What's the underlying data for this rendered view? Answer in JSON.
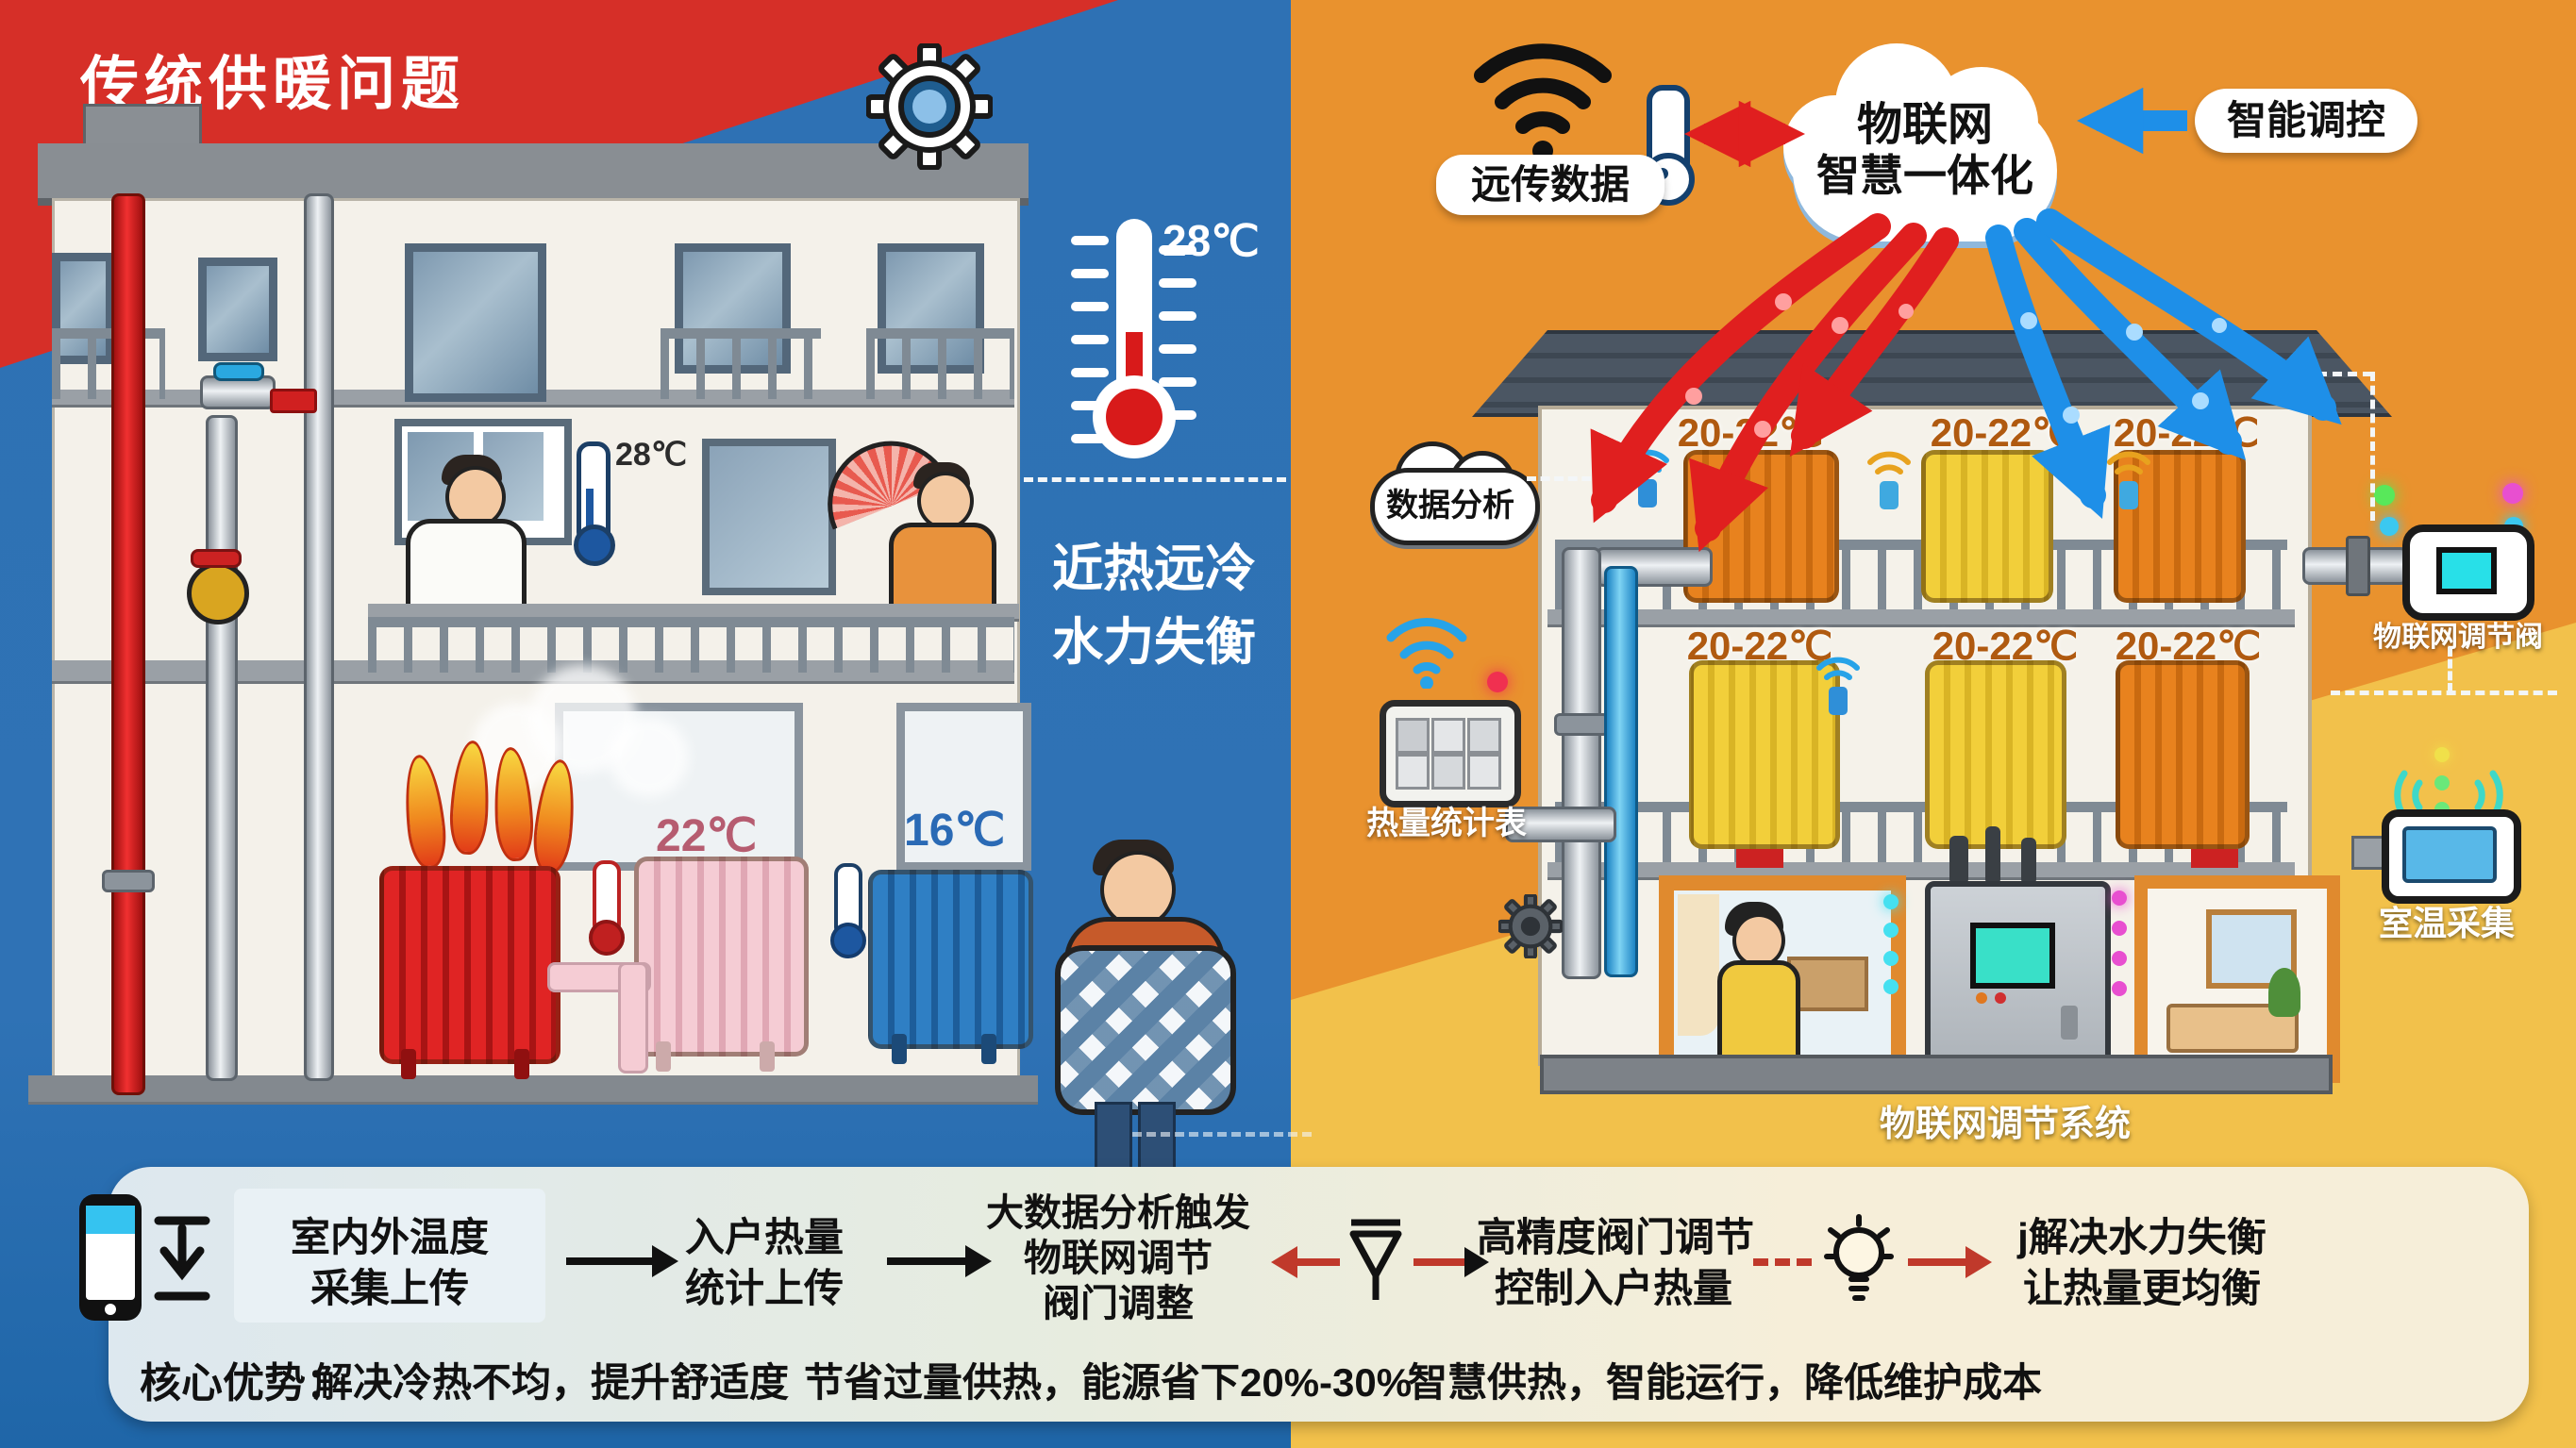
{
  "left": {
    "title": "传统供暖问题",
    "outdoor_temp": "28℃",
    "indoor_temp": "28℃",
    "radiator2_temp": "22℃",
    "radiator3_temp": "16℃",
    "slogan1": "近热远冷",
    "slogan2": "水力失衡"
  },
  "right": {
    "cloud_line1": "物联网",
    "cloud_line2": "智慧一体化",
    "remote_data": "远传数据",
    "smart_control": "智能调控",
    "data_analysis": "数据分析",
    "heat_meter": "热量统计表",
    "iot_valve": "物联网调节阀",
    "room_temp": "室温采集",
    "system_label": "物联网调节系统",
    "floor1_temps": [
      "20-22℃",
      "20-22℃",
      "20-22℃"
    ],
    "floor2_temps": [
      "20-22℃",
      "20-22℃",
      "20-22℃"
    ]
  },
  "flow": {
    "steps": [
      {
        "line1": "室内外温度",
        "line2": "采集上传"
      },
      {
        "line1": "入户热量",
        "line2": "统计上传"
      },
      {
        "line1": "大数据分析触发",
        "line2": "物联网调节",
        "line3": "阀门调整"
      },
      {
        "line1": "高精度阀门调节",
        "line2": "控制入户热量"
      },
      {
        "line1": "j解决水力失衡",
        "line2": "让热量更均衡"
      }
    ]
  },
  "advantages": {
    "heading": "核心优势：",
    "items": [
      "解决冷热不均，提升舒适度",
      "节省过量供热，能源省下20%-30%",
      "智慧供热，智能运行，降低维护成本"
    ]
  },
  "icons": {
    "wifi": "wifi-icon",
    "thermometer": "thermometer-icon",
    "gear": "gear-icon",
    "cloud": "cloud-icon",
    "phone": "phone-icon",
    "download": "download-icon",
    "valve_funnel": "valve-funnel-icon",
    "lightbulb": "lightbulb-icon",
    "loop_arrow": "loop-arrow-icon",
    "fan": "fan-icon"
  },
  "colors": {
    "left_bg": "#2e71b4",
    "banner_red": "#d62f28",
    "right_bg": "#e9922e",
    "right_bg_light": "#f2c14b",
    "arrow_red": "#e01f1f",
    "arrow_blue": "#1e8fe8",
    "bar_left": "#dde8ef",
    "bar_right": "#f6eed9",
    "temp_label": "#b05a10"
  }
}
